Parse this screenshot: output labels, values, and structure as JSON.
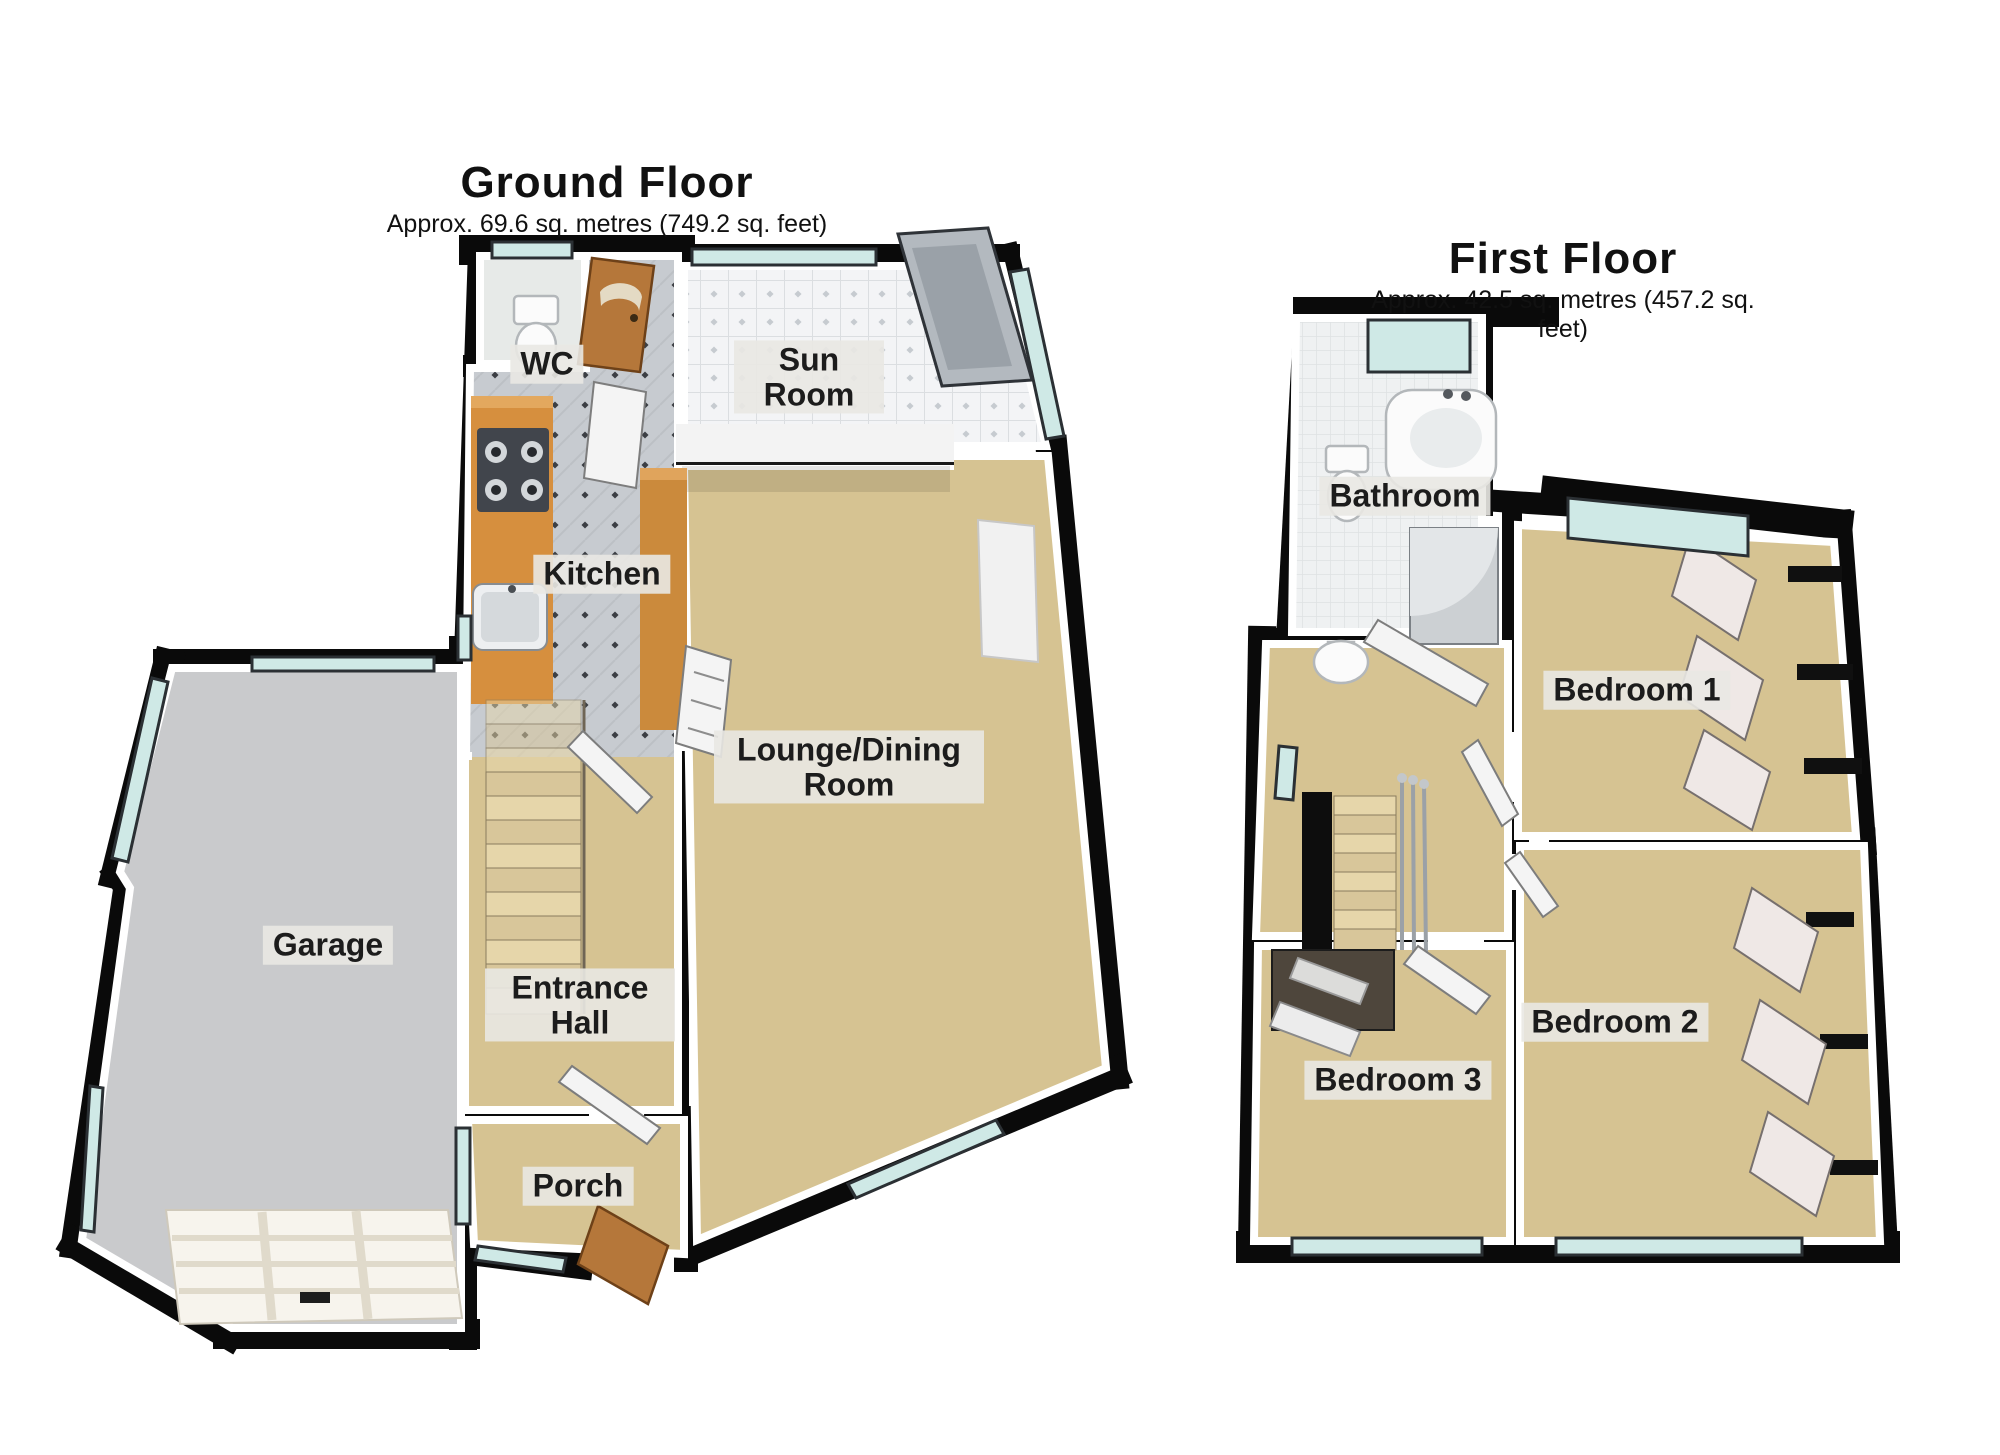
{
  "ground_floor": {
    "title": "Ground Floor",
    "subtitle": "Approx. 69.6 sq. metres (749.2 sq. feet)",
    "rooms": {
      "wc": "WC",
      "sun_room": "Sun Room",
      "kitchen": "Kitchen",
      "lounge": "Lounge/Dining Room",
      "garage": "Garage",
      "entrance_hall": "Entrance Hall",
      "porch": "Porch"
    }
  },
  "first_floor": {
    "title": "First Floor",
    "subtitle": "Approx. 42.5 sq. metres (457.2 sq. feet)",
    "rooms": {
      "bathroom": "Bathroom",
      "bedroom1": "Bedroom 1",
      "bedroom2": "Bedroom 2",
      "bedroom3": "Bedroom 3"
    }
  },
  "colors": {
    "wall": "#0a0a0a",
    "carpet": "#d6c392",
    "garage_floor": "#c9cacc",
    "window_glass": "#cfe9e6",
    "wood": "#b5773a",
    "counter": "#d68f3e",
    "label_text": "#1c1c1c"
  }
}
